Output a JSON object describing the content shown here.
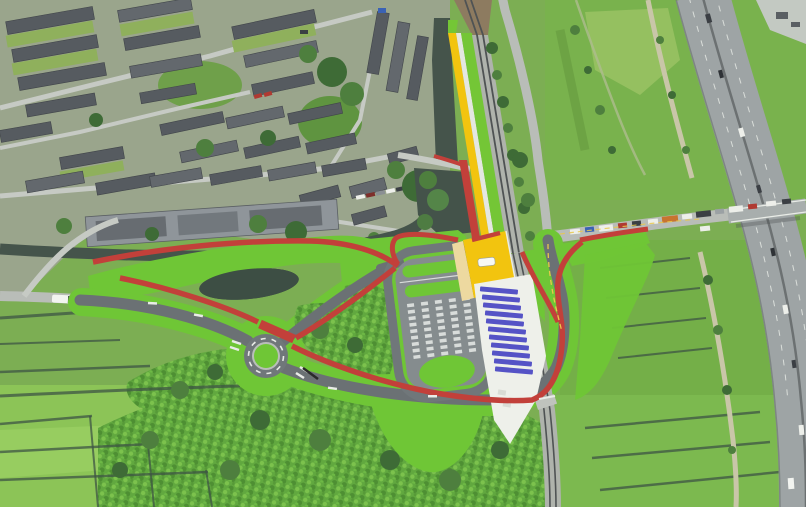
{
  "meta": {
    "description": "Aerial photograph of a Dutch semi-rural area with a coloured plan overlay: a new link road with roundabout, park-and-ride car park, yellow platform strip along the railway, blue covered bays and red cycle paths, between a residential neighbourhood (top-left) and a motorway (right)."
  },
  "colors": {
    "photo_green": "#7CAE53",
    "urban_base": "#9AA58C",
    "meadow": "#8CC457",
    "meadow_light": "#97CD60",
    "field_right": "#79B24D",
    "orchard_base": "#61A83F",
    "tree_dark": "#3E6B36",
    "water": "#45544B",
    "pond": "#3D4E44",
    "overlay_red": "#C2403A",
    "overlay_green": "#6FC636",
    "new_asphalt": "#6B7174",
    "lot_asphalt": "#858C8E",
    "ring_asphalt": "#70777A",
    "platform_yellow": "#F2C40F",
    "platform_cream": "#EDD9A0",
    "shelter_blue": "#5553C6",
    "apron_white": "#EEF0EA",
    "white_band": "#E4E7E1",
    "road_existing": "#B9BDB8",
    "road_light": "#C6CAC4",
    "highway": "#9EA4A5",
    "rail_ballast": "#AFB3AC",
    "rail_brown": "#8D7B60",
    "rail_dark": "#4F5354",
    "roof_dark": "#565B60",
    "roof_light": "#8F959A",
    "path_tan": "#C9C6A8",
    "marking_white": "#E9ECE7",
    "marking_yellow": "#E8C84C",
    "vehicle_red": "#B03A32",
    "vehicle_blue": "#3A62B5"
  },
  "scene": {
    "counts": {
      "shelter_bays": 11,
      "parking_columns": 5,
      "roundabout_arms": 3
    }
  }
}
